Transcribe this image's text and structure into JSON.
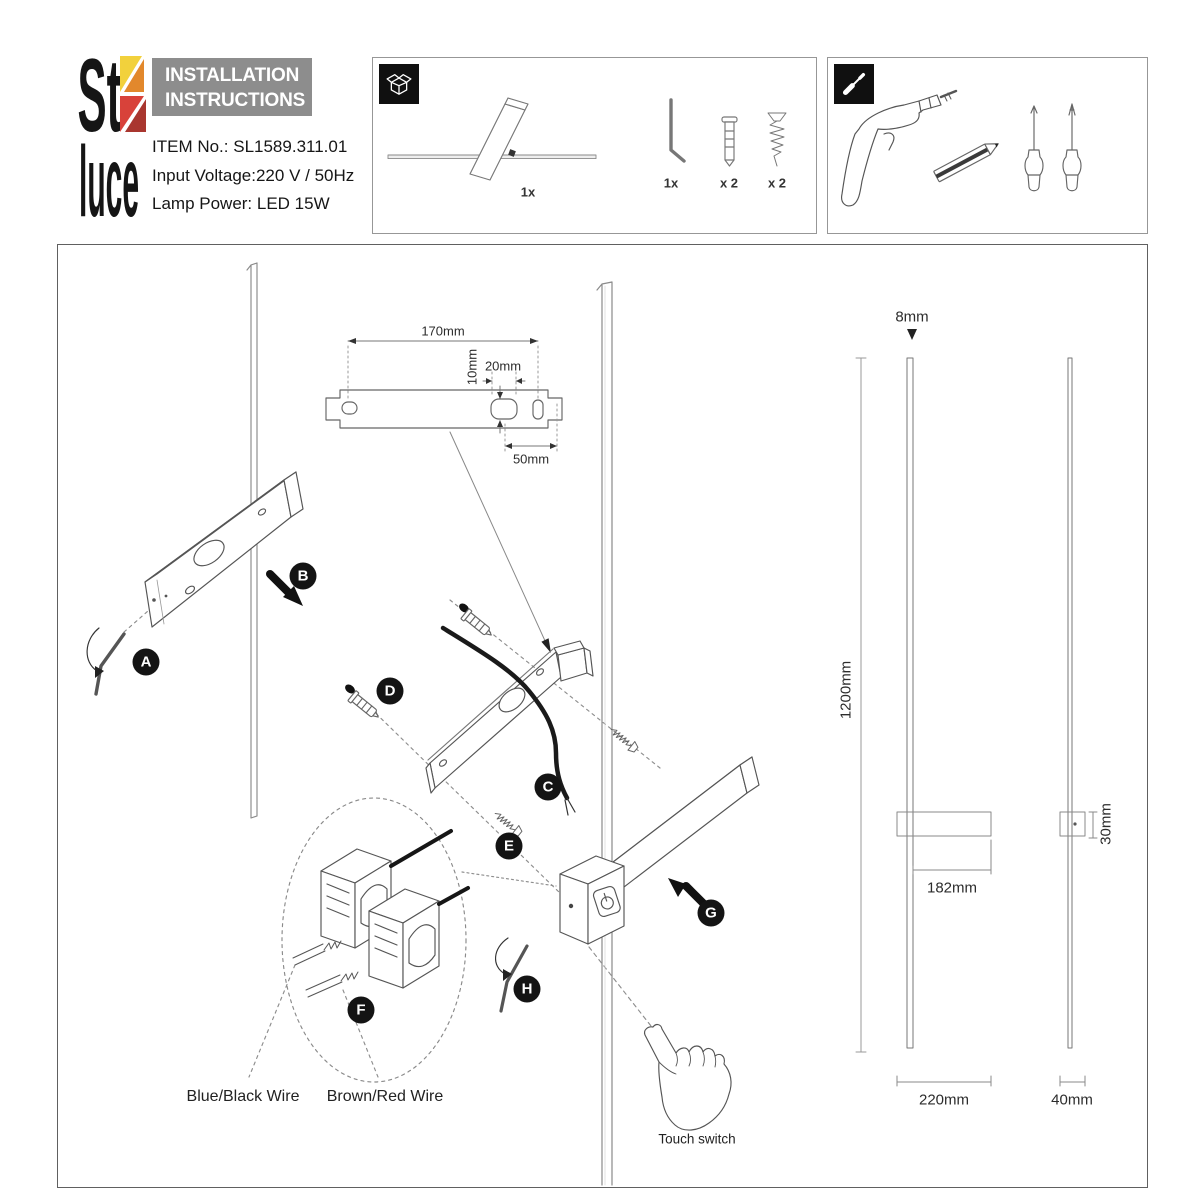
{
  "brand": {
    "logo_line1": "St",
    "logo_line2": "luce",
    "colors": {
      "yellow": "#f2d13c",
      "orange": "#e2882c",
      "red": "#d8423a",
      "dark_red": "#a9362f"
    }
  },
  "header": {
    "title_line1": "INSTALLATION",
    "title_line2": "INSTRUCTIONS",
    "item_no": "ITEM No.: SL1589.311.01",
    "input_voltage": "Input Voltage:220 V / 50Hz",
    "lamp_power": "Lamp Power: LED 15W"
  },
  "package_box": {
    "icon": "package-icon",
    "lamp_count": "1x",
    "hex_key_count": "1x",
    "anchor_count": "x 2",
    "screw_count": "x 2"
  },
  "tools_box": {
    "icon": "screwdriver-icon",
    "tools": [
      "drill",
      "pencil",
      "phillips-screwdriver",
      "flat-screwdriver"
    ]
  },
  "diagram": {
    "steps": [
      "A",
      "B",
      "C",
      "D",
      "E",
      "F",
      "G",
      "H"
    ],
    "wire_labels": {
      "blue_black": "Blue/Black Wire",
      "brown_red": "Brown/Red Wire"
    },
    "touch_switch_label": "Touch switch",
    "dimensions": {
      "bracket_length": "170mm",
      "slot_height": "10mm",
      "slot_width": "20mm",
      "slot_to_hole": "50mm",
      "rod_diameter": "8mm",
      "lamp_height": "1200mm",
      "arm_length": "182mm",
      "box_height": "30mm",
      "base_width": "220mm",
      "side_width": "40mm"
    }
  }
}
